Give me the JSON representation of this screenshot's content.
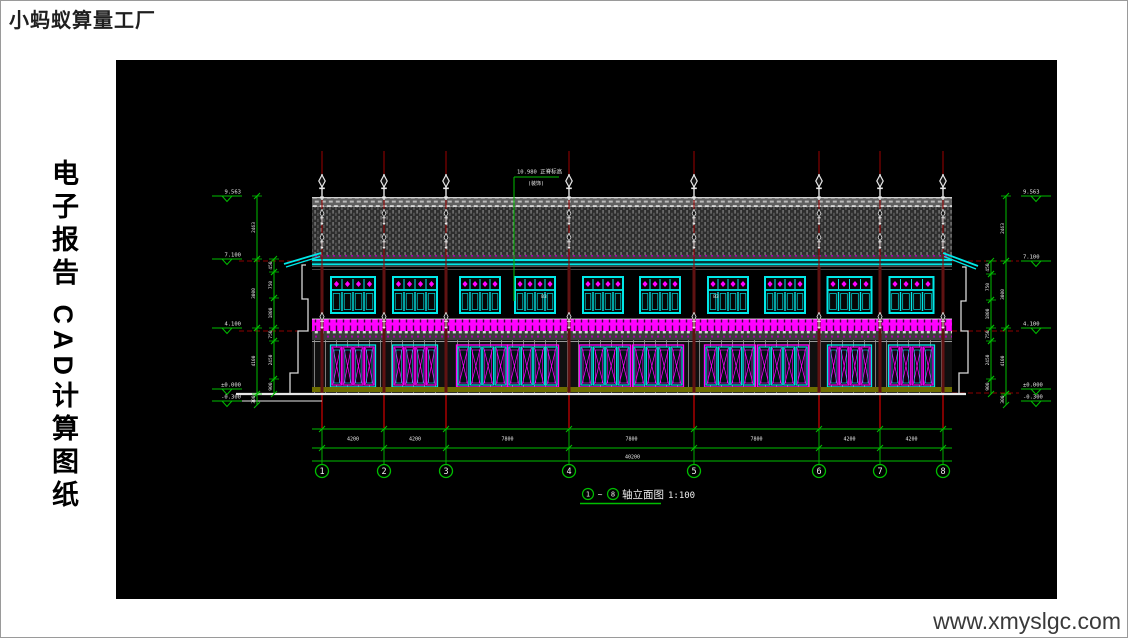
{
  "page": {
    "brand": "小蚂蚁算量工厂",
    "side_title": "电子报告 CAD计算图纸",
    "website": "www.xmyslgc.com"
  },
  "drawing": {
    "colors": {
      "green": "#00BE00",
      "red": "#A00000",
      "darkred": "#8C0000",
      "cyan": "#00E8E8",
      "magenta": "#FF00FF",
      "white": "#E8E8E8",
      "olive": "#6D6D00"
    },
    "title": {
      "pre": "1",
      "tilde": "~",
      "post": "8",
      "name": "轴立面图",
      "scale": "1:100"
    },
    "grids": [
      {
        "label": "1",
        "x": 206
      },
      {
        "label": "2",
        "x": 268
      },
      {
        "label": "3",
        "x": 330
      },
      {
        "label": "4",
        "x": 453
      },
      {
        "label": "5",
        "x": 578
      },
      {
        "label": "6",
        "x": 703
      },
      {
        "label": "7",
        "x": 764
      },
      {
        "label": "8",
        "x": 827
      }
    ],
    "dims_bottom": {
      "segments": [
        "4200",
        "4200",
        "7800",
        "7800",
        "7800",
        "4200",
        "4200"
      ],
      "overall": "40200"
    },
    "levels_left": [
      {
        "value": "9.563",
        "y": 136
      },
      {
        "value": "7.100",
        "y": 199
      },
      {
        "value": "4.100",
        "y": 268
      },
      {
        "value": "±0.000",
        "y": 329
      },
      {
        "value": "-0.300",
        "y": 341
      }
    ],
    "levels_right": [
      {
        "value": "9.563",
        "y": 136
      },
      {
        "value": "7.100",
        "y": 201
      },
      {
        "value": "4.100",
        "y": 268
      },
      {
        "value": "±0.000",
        "y": 329
      },
      {
        "value": "-0.300",
        "y": 341
      }
    ],
    "vchain": {
      "left_outer": [
        [
          136,
          199,
          "2463"
        ],
        [
          199,
          268,
          "3000"
        ],
        [
          268,
          334,
          "4100"
        ],
        [
          334,
          345,
          "300"
        ]
      ],
      "left_inner": [
        [
          199,
          212,
          "450"
        ],
        [
          212,
          238,
          "750"
        ],
        [
          238,
          268,
          "1800"
        ],
        [
          268,
          281,
          "750"
        ],
        [
          281,
          319,
          "2450"
        ],
        [
          319,
          334,
          "900"
        ]
      ],
      "right_outer": [
        [
          136,
          201,
          "2463"
        ],
        [
          201,
          268,
          "3000"
        ],
        [
          268,
          334,
          "4100"
        ],
        [
          334,
          345,
          "300"
        ]
      ],
      "right_inner": [
        [
          201,
          214,
          "450"
        ],
        [
          214,
          240,
          "750"
        ],
        [
          240,
          268,
          "1800"
        ],
        [
          268,
          281,
          "750"
        ],
        [
          281,
          319,
          "2450"
        ],
        [
          319,
          334,
          "900"
        ]
      ]
    },
    "ridge_note": {
      "l1": "10.980 正脊标高",
      "l2": "(装饰)"
    },
    "window_tags": [
      {
        "x": 428,
        "y": 238,
        "t": "B3"
      },
      {
        "x": 600,
        "y": 238,
        "t": "B3"
      }
    ]
  }
}
